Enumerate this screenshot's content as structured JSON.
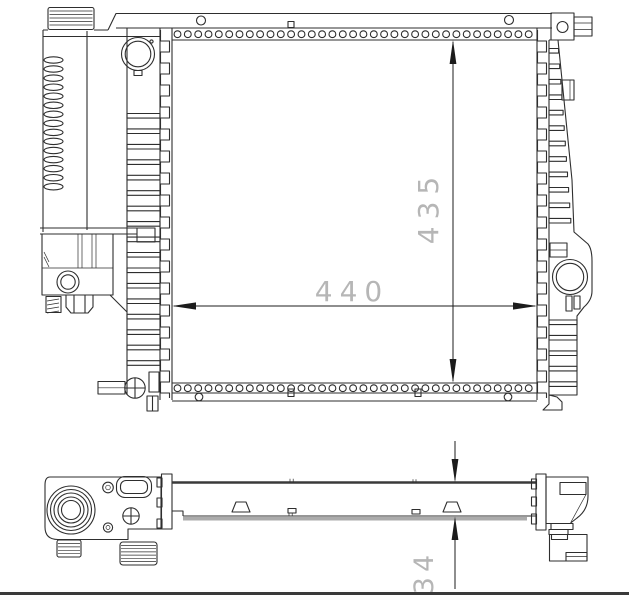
{
  "dimensions": {
    "core_width_label": "440",
    "core_height_label": "435",
    "core_depth_label": "34"
  },
  "colors": {
    "line": "#2e2e2e",
    "line_strong": "#3a3a3a",
    "dim_line": "#1c1c1c",
    "dim_text": "#b6b6b6",
    "background": "#ffffff"
  }
}
